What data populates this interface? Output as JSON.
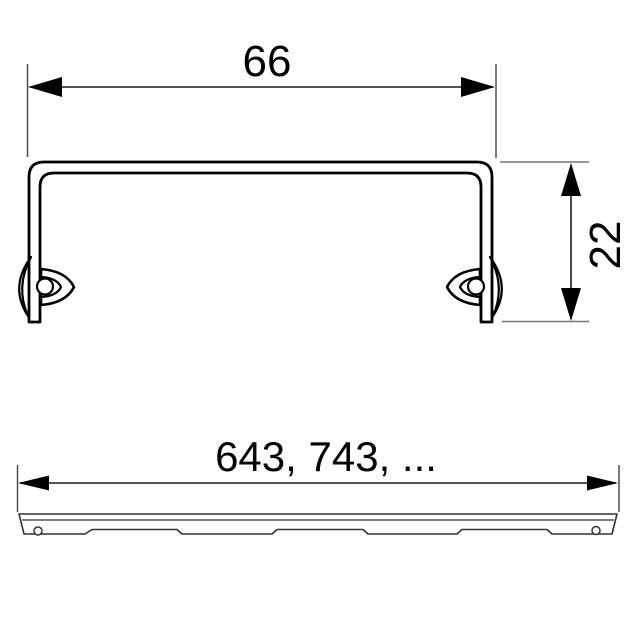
{
  "dimensions": {
    "width": {
      "label": "66"
    },
    "height": {
      "label": "22"
    },
    "length": {
      "label": "643, 743, ..."
    }
  },
  "colors": {
    "profile_line": "#000000",
    "dimension_line": "#1a1a1a",
    "extension_line": "#777777",
    "thin_outline": "#333333",
    "background": "#ffffff"
  }
}
